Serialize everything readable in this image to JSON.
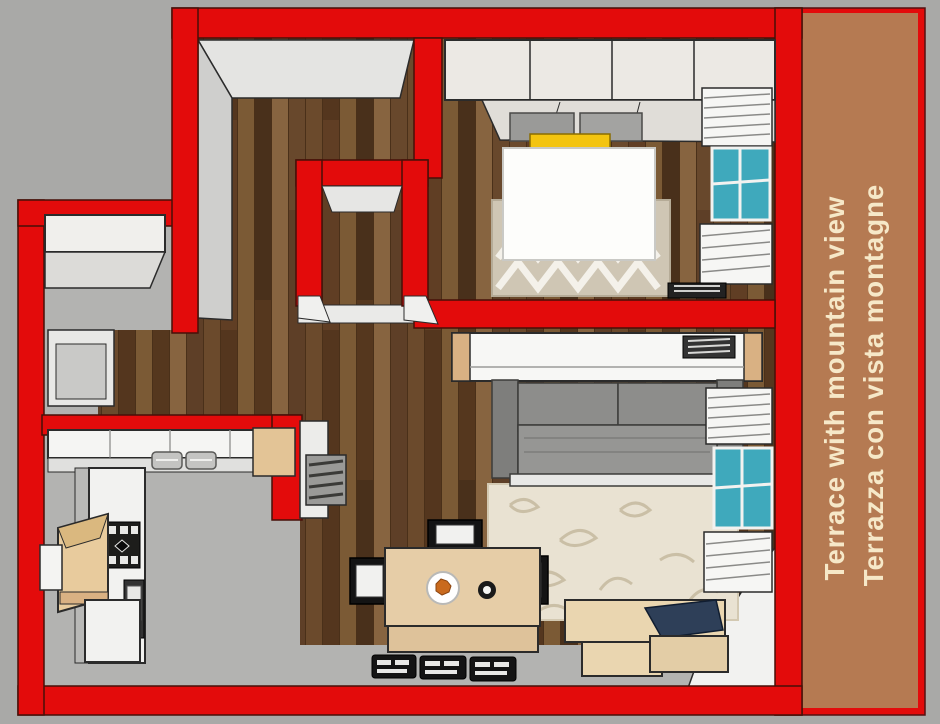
{
  "terrace": {
    "line1": "Terrace with mountain view",
    "line2": "Terrazza con vista montagne"
  },
  "colors": {
    "wall_red": "#e30b0b",
    "terrace_tan": "#b57a52",
    "background_gray": "#a9a9a7",
    "floor_gray": "#b3b3b1",
    "wood_dark": "#5b3c24",
    "accent_yellow": "#f3c410",
    "window_teal": "#3fa9bc",
    "text_cream": "#f6e8c8",
    "sofa_gray": "#8d8d8b",
    "furniture_wood": "#e6cda7"
  }
}
